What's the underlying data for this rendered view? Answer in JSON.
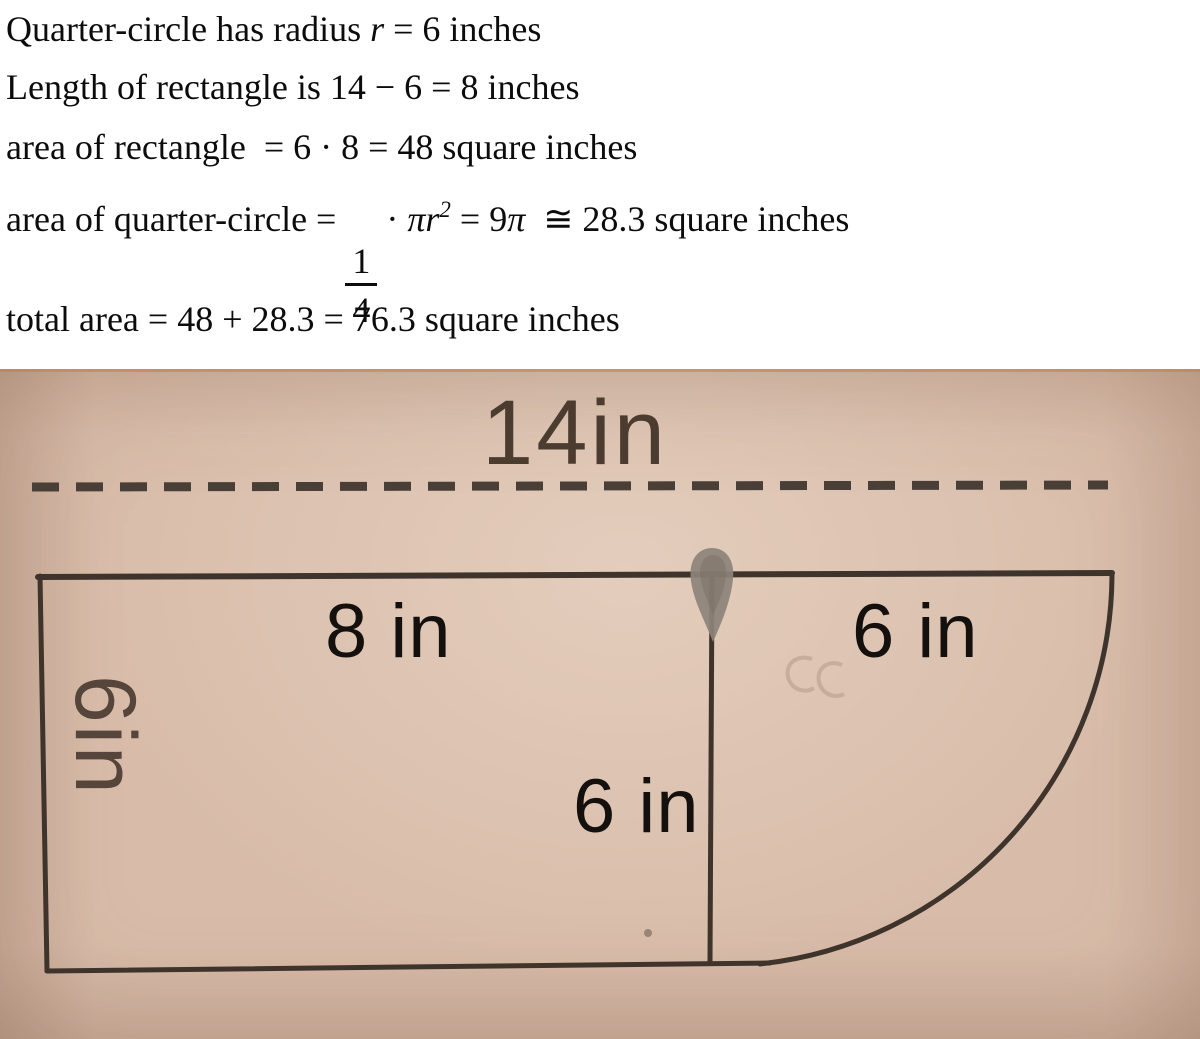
{
  "solution": {
    "line1_pre": "Quarter-circle has radius ",
    "line1_var": "r",
    "line1_post": " = 6 inches",
    "line2": "Length of rectangle is 14 − 6 = 8 inches",
    "line3": "area of rectangle  = 6 · 8 = 48 square inches",
    "line4_pre": "area of quarter-circle = ",
    "line4_frac_num": "1",
    "line4_frac_den": "4",
    "line4_dot": " · ",
    "line4_pir": "πr",
    "line4_exp": "2",
    "line4_eq": " = 9",
    "line4_pi2": "π",
    "line4_post": "  ≅ 28.3 square inches",
    "line5": "total area = 48 + 28.3 = 76.3 square inches"
  },
  "figure": {
    "top_label": "14in",
    "label_8in": "8 in",
    "label_6in_right": "6 in",
    "label_6in_mid": "6 in",
    "label_6in_left": "6in",
    "colors": {
      "paper": "#d8bca9",
      "ink": "#3e342c",
      "typed_label": "#14100d",
      "printed_label": "#4c3c30",
      "smudge": "#8c837a"
    }
  }
}
